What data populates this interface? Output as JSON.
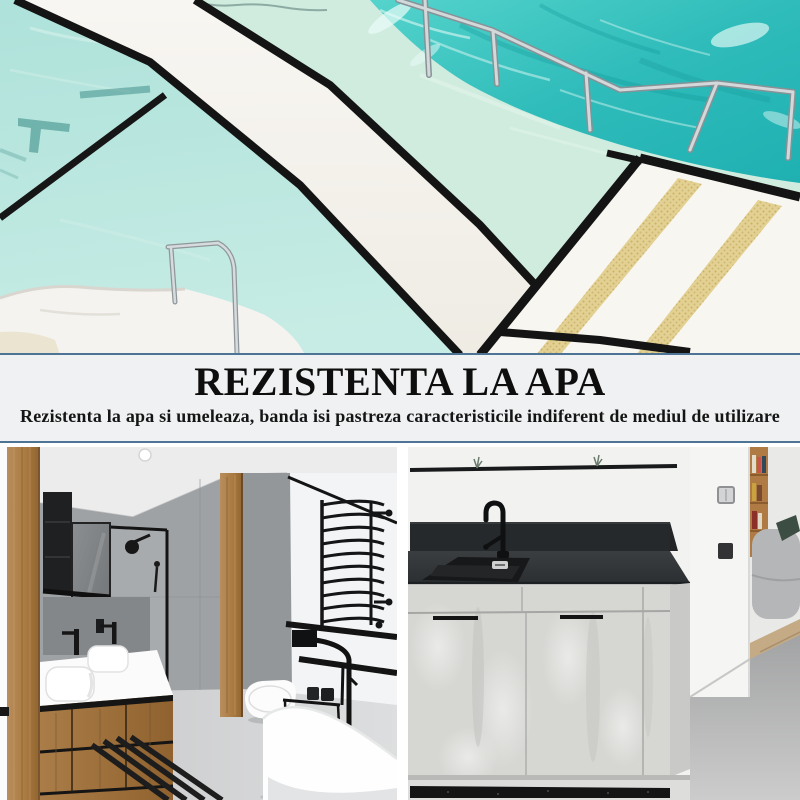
{
  "page": {
    "type": "product-marketing-collage",
    "width": 800,
    "height": 800
  },
  "banner": {
    "title": "REZISTENTA LA APA",
    "subtitle": "Rezistenta la apa si umeleaza, banda isi pastreza caracteristicile indiferent de mediul de utilizare",
    "background": "#f0f1f2",
    "border_color": "#4d7495",
    "text_color": "#0e0e0e"
  },
  "photos": {
    "pool": {
      "label": "outdoor pool deck with black anti-slip tape lines",
      "water_turquoise": "#2fbcba",
      "water_pale": "#b5e5dd",
      "deck_white": "#f6f4ef",
      "tape_black": "#161616",
      "tactile_strip_tan": "#e3d193",
      "handrail_steel": "#c6cccf"
    },
    "bathroom": {
      "label": "grey and wood bathroom with black tape accents",
      "wood": "#ab7c49",
      "tile_grey": "#9aa0a2",
      "tape_black": "#141414",
      "floor_grey": "#d2d3d4"
    },
    "kitchen": {
      "label": "kitchen unit with dark worktop and black floor strip",
      "worktop_dark": "#303437",
      "cabinet_concrete": "#d6d6d3",
      "tape_black": "#1b1b1b",
      "wall_white": "#f2f2f1"
    }
  }
}
